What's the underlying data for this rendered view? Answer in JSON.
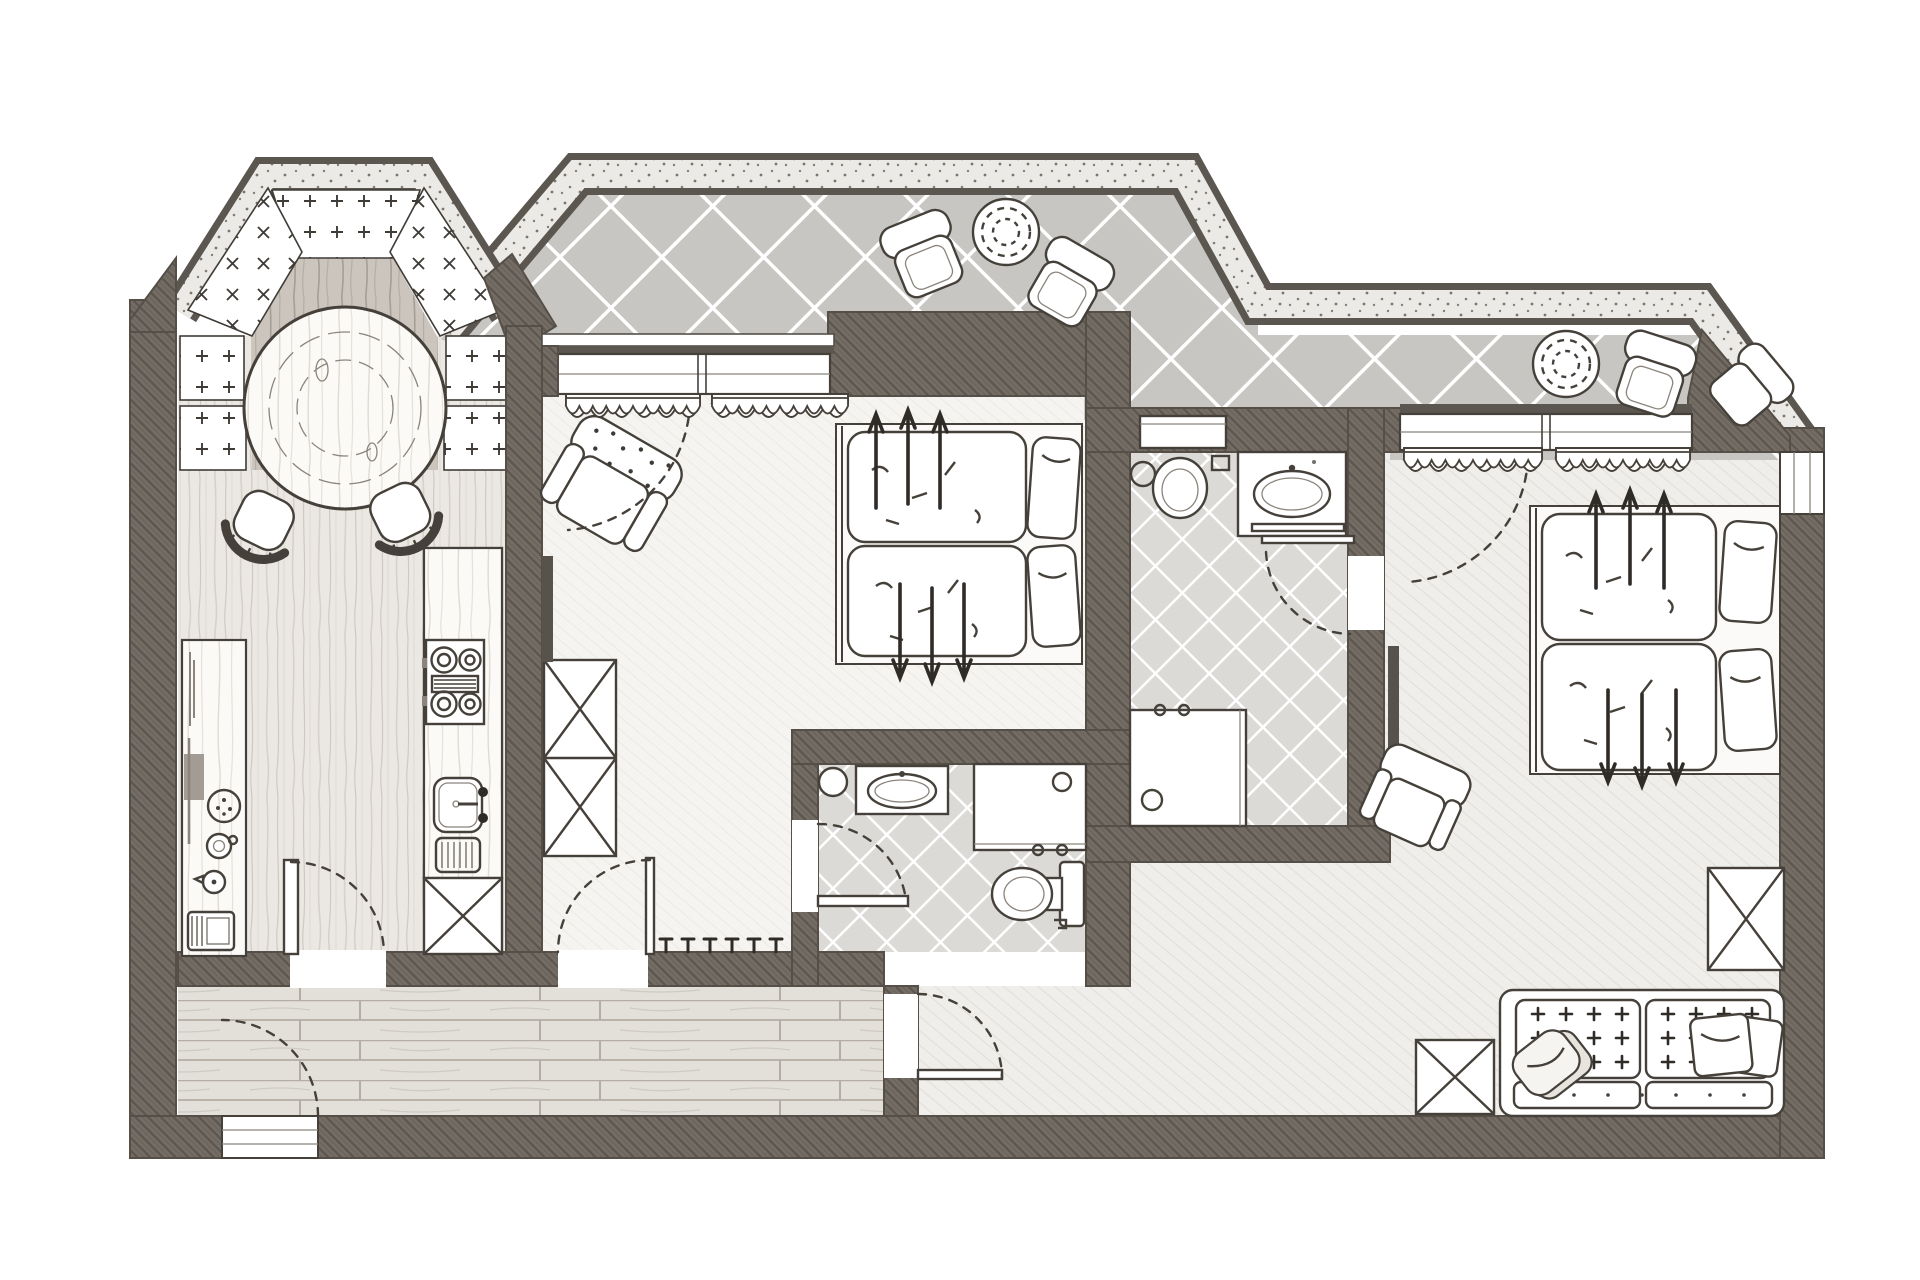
{
  "document": {
    "kind": "architectural-floor-plan",
    "style": "hand-drawn pencil sketch, top-down apartment suite plan, grayscale",
    "visible_text": []
  },
  "palette": {
    "paper": "#ffffff",
    "wall": "#746d66",
    "wall_line": "#554f48",
    "ink": "#45403a",
    "speckle_band": "#eceae6",
    "terrace_tile": "#c8c6c3",
    "bath_tile": "#dcdad7",
    "kitchen_wood": "#ebe8e3",
    "bay_wood_dark": "#cbc5bd",
    "hall_plank": "#e3e0da",
    "bedroom_floor": "#f5f4f1",
    "lounge_floor": "#efeeea",
    "tv_dark": "#57524b"
  },
  "rooms": [
    {
      "id": "bay-dining-nook",
      "furniture": [
        "round-wooden-table",
        "dining-chair",
        "dining-chair",
        "window-sill-panel-plus",
        "window-sill-panel-cross"
      ]
    },
    {
      "id": "kitchen",
      "furniture": [
        "sideboard-counter",
        "serving-tray",
        "plate",
        "cup",
        "kettle",
        "toaster",
        "kitchen-counter",
        "cooktop-4-burner",
        "sink-with-drainboard",
        "tall-cabinet-x"
      ]
    },
    {
      "id": "hallway",
      "furniture": [
        "entry-door",
        "coat-hooks",
        "plank-floor"
      ]
    },
    {
      "id": "bedroom-1",
      "furniture": [
        "double-bed",
        "pillow",
        "pillow",
        "duvet-arrows",
        "polka-dot-armchair",
        "wardrobe-x",
        "wall-tv",
        "curtained-window",
        "terrace-door-swing"
      ]
    },
    {
      "id": "bathroom-1",
      "furniture": [
        "vanity-sink",
        "round-stool",
        "shower-cabin",
        "toilet",
        "door-leaf",
        "diamond-tile-floor"
      ]
    },
    {
      "id": "bathroom-2",
      "furniture": [
        "toilet",
        "cistern-cabinet",
        "toilet-brush",
        "vanity-sink",
        "towel-bars",
        "shower-cabin",
        "diamond-tile-floor"
      ]
    },
    {
      "id": "bedroom-2",
      "furniture": [
        "double-bed",
        "pillow",
        "pillow",
        "duvet-arrows",
        "armchair",
        "wall-tv",
        "sofa-two-seat",
        "sofa-pillows",
        "coffee-table-x",
        "cabinet-x",
        "curtained-window",
        "east-window",
        "terrace-door-swing"
      ]
    },
    {
      "id": "terrace-1",
      "furniture": [
        "outdoor-armchair",
        "outdoor-armchair",
        "round-wicker-table",
        "diamond-tile-paving",
        "speckled-curb"
      ]
    },
    {
      "id": "terrace-2",
      "furniture": [
        "round-wicker-table",
        "outdoor-armchair",
        "outdoor-armchair",
        "diamond-tile-paving",
        "speckled-curb"
      ]
    }
  ],
  "doors": [
    "entry-door-bottom-left",
    "kitchen-to-hall",
    "bedroom-1-to-hall",
    "bathroom-1-door",
    "bathroom-2-door",
    "hall-to-bedroom-2-lounge"
  ],
  "windows": [
    "bay-window-band",
    "bedroom-1-terrace-window",
    "bedroom-2-terrace-window",
    "bedroom-2-east-window"
  ]
}
